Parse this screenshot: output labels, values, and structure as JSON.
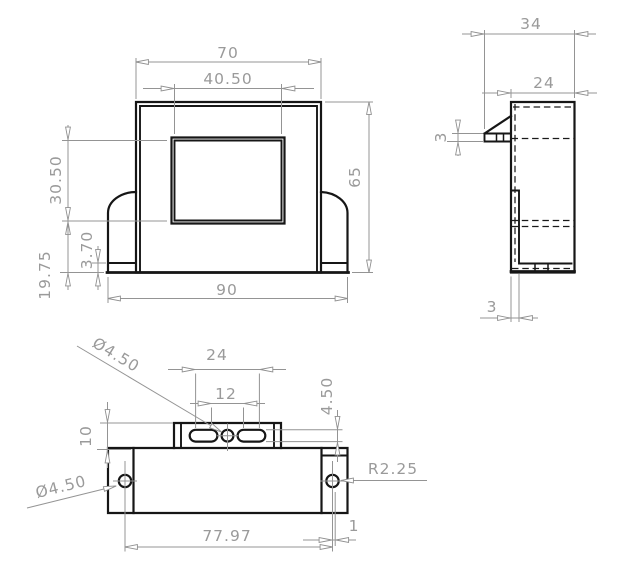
{
  "drawing": {
    "type": "engineering-drawing",
    "background": "#ffffff",
    "object_line_color": "#161616",
    "dimension_color": "#949494",
    "front": {
      "overall_width": "70",
      "window_width": "40.50",
      "overall_height": "65",
      "window_height": "30.50",
      "base_lip": "3.70",
      "lower_section": "19.75",
      "base_width": "90"
    },
    "side": {
      "overall_depth": "34",
      "body_depth": "24",
      "flange_thickness": "3",
      "wall_thickness": "3"
    },
    "bottom": {
      "slot_span_outer": "24",
      "slot_span_inner": "12",
      "slot_width": "4.50",
      "tab_depth": "10",
      "center_hole_dia": "Ø4.50",
      "side_hole_dia": "Ø4.50",
      "slot_radius": "R2.25",
      "hole_spacing": "77.97",
      "hole_edge_offset": "1"
    }
  }
}
